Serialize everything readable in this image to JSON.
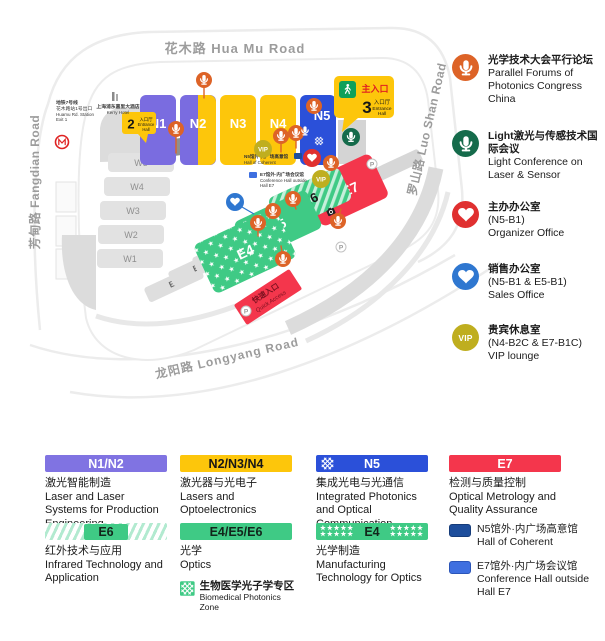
{
  "map": {
    "roads": {
      "top": "花木路  Hua Mu Road",
      "right": "罗山路  Luo Shan Road",
      "left": "芳甸路  Fangdian Road",
      "bottom": "龙阳路  Longyang Road"
    },
    "halls": {
      "n1": "N1",
      "n2": "N2",
      "n3": "N3",
      "n4": "N4",
      "n5": "N5",
      "w1": "W1",
      "w2": "W2",
      "w3": "W3",
      "w4": "W4",
      "w5": "W5",
      "e1": "E1",
      "e2": "E2",
      "e3": "E3",
      "e4": "E4",
      "e5": "E5",
      "e6": "E6",
      "e7": "E7"
    },
    "entrance_main": {
      "label": "主入口",
      "number": "3",
      "hall_cn": "入口厅",
      "hall_en1": "Entrance",
      "hall_en2": "Hall"
    },
    "entrance_2": {
      "number": "2",
      "hall_cn": "入口厅",
      "hall_en1": "Entrance",
      "hall_en2": "Hall"
    },
    "quick_access": {
      "cn": "快速入口",
      "en": "Quick Access"
    },
    "metro_note": {
      "line1": "地铁7号线",
      "line2": "花木路站1号出口",
      "line3": "Huamu Rd. Station",
      "line4": "Exit 1"
    },
    "hotel_note": {
      "cn": "上海浦东嘉里大酒店",
      "en": "Kerry Hotel"
    },
    "coherent_note": {
      "cn": "N5馆外·内广场高意馆",
      "en": "Hall of Coherent"
    },
    "conference_note": {
      "cn": "E7馆外·内广场会议馆",
      "en1": "Conference Hall outside",
      "en2": "Hall E7"
    },
    "vip_badge": "VIP",
    "parking": "P"
  },
  "side_legend": {
    "items": [
      {
        "icon": "microphone",
        "color": "#DD6327",
        "title_cn": "光学技术大会平行论坛",
        "title_en": "Parallel Forums of Photonics Congress China"
      },
      {
        "icon": "microphone",
        "color": "#156B4B",
        "title_cn": "Light激光与传感技术国际会议",
        "title_en": "Light Conference on Laser & Sensor"
      },
      {
        "icon": "handshake",
        "color": "#E03030",
        "title_cn": "主办办公室",
        "subtitle": "(N5-B1)",
        "title_en": "Organizer Office"
      },
      {
        "icon": "handshake",
        "color": "#2F77D0",
        "title_cn": "销售办公室",
        "subtitle": "(N5-B1 & E5-B1)",
        "title_en": "Sales Office"
      },
      {
        "icon": "vip",
        "color": "#BFAE1F",
        "icon_label": "VIP",
        "title_cn": "贵宾休息室",
        "subtitle": "(N4-B2C & E7-B1C)",
        "title_en": "VIP lounge"
      }
    ]
  },
  "bottom_legend": {
    "star_row": "★★★★★",
    "items": [
      {
        "badge": "N1/N2",
        "style": "purple",
        "color": "#8073E2",
        "cn": "激光智能制造",
        "en": "Laser and Laser Systems for Production Engineering"
      },
      {
        "badge": "N2/N3/N4",
        "style": "yellow",
        "color": "#FDC60B",
        "cn": "激光器与光电子",
        "en": "Lasers and Optoelectronics"
      },
      {
        "badge": "N5",
        "style": "blue-hatch",
        "color": "#2B50D9",
        "cn": "集成光电与光通信",
        "en": "Integrated Photonics and Optical Communication"
      },
      {
        "badge": "E7",
        "style": "red",
        "color": "#F4364C",
        "cn": "检测与质量控制",
        "en": "Optical Metrology and Quality Assurance"
      },
      {
        "badge": "E6",
        "style": "green-stripes",
        "color": "#3FCA85",
        "cn": "红外技术与应用",
        "en": "Infrared Technology and Application"
      },
      {
        "badge": "E4/E5/E6",
        "style": "green",
        "color": "#3FCA85",
        "cn": "光学",
        "en": "Optics",
        "sub_cn": "生物医学光子学专区",
        "sub_en": "Biomedical Photonics Zone"
      },
      {
        "badge": "E4",
        "style": "green-stars",
        "color": "#3FCA85",
        "cn": "光学制造",
        "en": "Manufacturing Technology for Optics"
      }
    ],
    "notes": [
      {
        "swatch": "#1E4E9C",
        "cn": "N5馆外·内广场高意馆",
        "en": "Hall of Coherent"
      },
      {
        "swatch": "#3E6FE0",
        "cn": "E7馆外·内广场会议馆",
        "en": "Conference Hall outside Hall E7"
      }
    ]
  }
}
